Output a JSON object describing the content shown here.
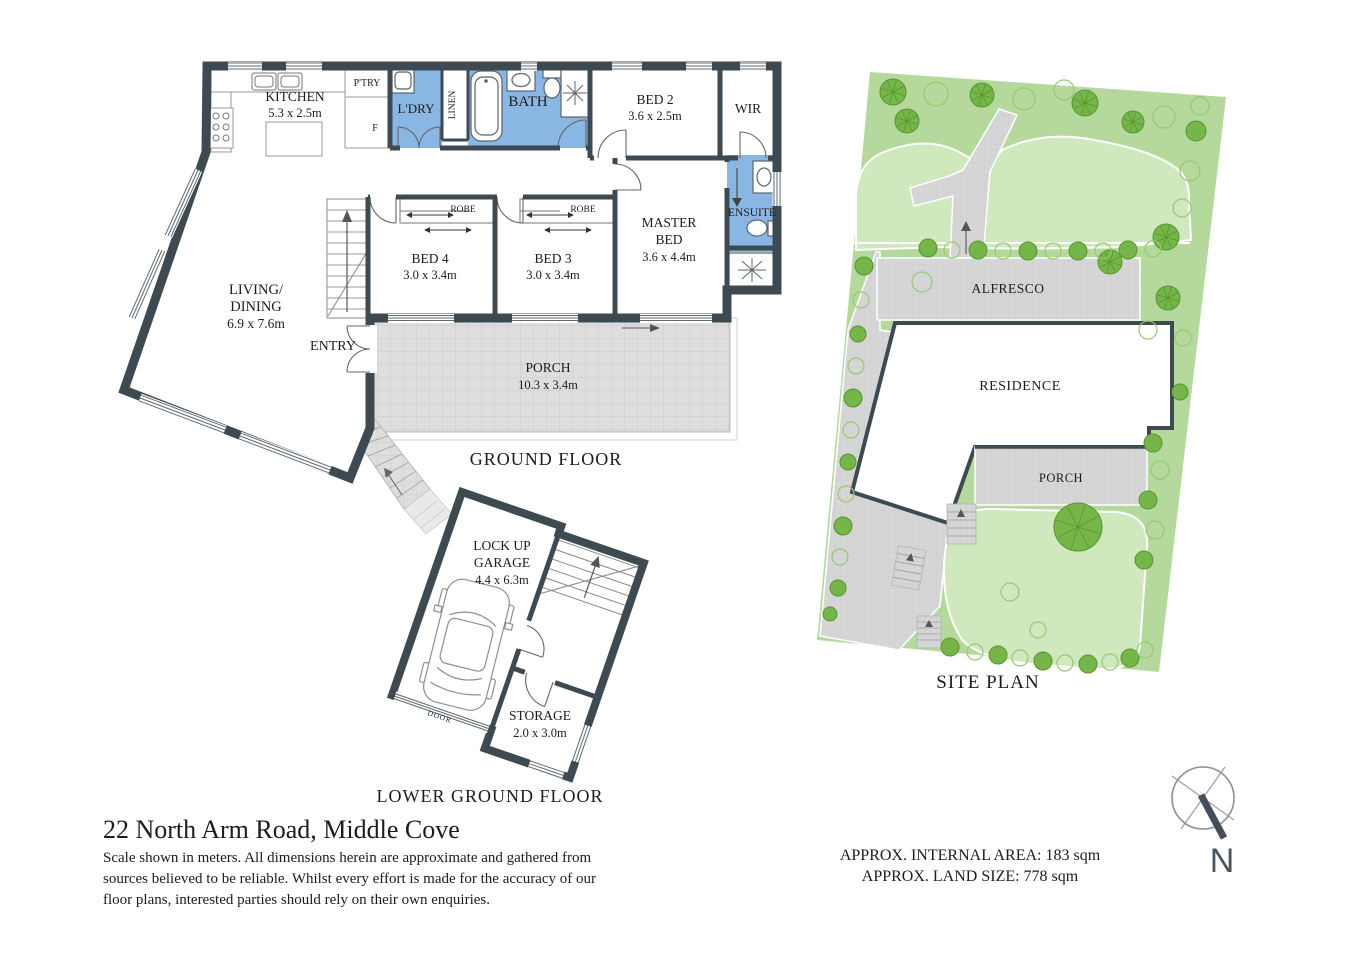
{
  "title": {
    "address": "22 North Arm Road, Middle Cove"
  },
  "disclaimer": [
    "Scale shown in meters. All dimensions herein are approximate and gathered from",
    "sources believed to be reliable. Whilst every effort is made for the accuracy of our",
    "floor plans, interested parties should rely on their own enquiries."
  ],
  "areas": {
    "internal": "APPROX. INTERNAL AREA: 183 sqm",
    "land": "APPROX. LAND SIZE: 778 sqm"
  },
  "compass": {
    "label": "N"
  },
  "ground_floor": {
    "title": "GROUND FLOOR",
    "kitchen_name": "KITCHEN",
    "kitchen_dims": "5.3 x 2.5m",
    "pantry": "P'TRY",
    "fridge": "F",
    "laundry": "L'DRY",
    "linen": "LINEN",
    "bath": "BATH",
    "bed2_name": "BED 2",
    "bed2_dims": "3.6 x 2.5m",
    "wir": "WIR",
    "ensuite": "ENSUITE",
    "master_l1": "MASTER",
    "master_l2": "BED",
    "master_dims": "3.6 x 4.4m",
    "bed4_name": "BED 4",
    "bed4_dims": "3.0 x 3.4m",
    "bed3_name": "BED 3",
    "bed3_dims": "3.0 x 3.4m",
    "robe": "ROBE",
    "living_l1": "LIVING/",
    "living_l2": "DINING",
    "living_dims": "6.9 x 7.6m",
    "entry": "ENTRY",
    "porch_name": "PORCH",
    "porch_dims": "10.3 x 3.4m"
  },
  "lower_ground_floor": {
    "title": "LOWER GROUND FLOOR",
    "garage_l1": "LOCK UP",
    "garage_l2": "GARAGE",
    "garage_dims": "4.4 x 6.3m",
    "storage_name": "STORAGE",
    "storage_dims": "2.0 x 3.0m",
    "door": "DOOR"
  },
  "site_plan": {
    "title": "SITE PLAN",
    "alfresco": "ALFRESCO",
    "residence": "RESIDENCE",
    "porch": "PORCH"
  },
  "colors": {
    "wall": "#3E4A52",
    "wet_area": "#8AB6E4",
    "paving": "#D9D9D9",
    "site_band_green": "#B5D99C",
    "site_lawn_green": "#CFE8BD",
    "tree_green": "#76B549",
    "text": "#1C1C1C"
  }
}
